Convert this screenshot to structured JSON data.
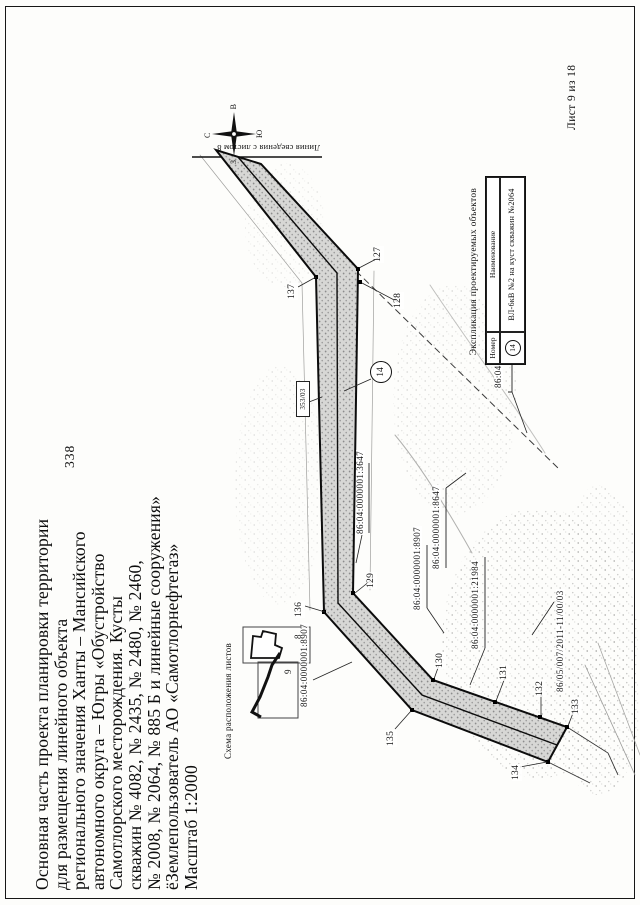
{
  "page": {
    "number": "338",
    "sheet_label": "Лист 9 из 18"
  },
  "title": {
    "lines": [
      "Основная часть проекта планировки территории",
      "для размещения линейного объекта",
      "регионального значения Ханты – Мансийского",
      "автономного округа – Югры «Обустройство",
      "Самотлорского месторождения. Кусты",
      "скважин № 4082, № 2435, № 2480, № 2460,",
      "№ 2008, № 2064, № 885 Б и линейные сооружения»",
      "ёЗемлепользователь АО «Самотлорнефтегаз»",
      "Масштаб 1:2000"
    ]
  },
  "compass": {
    "north": "С",
    "south": "Ю",
    "west": "З",
    "east": "В"
  },
  "map": {
    "match_line_label": "Линия сведения с листом 8",
    "marker_14": "14",
    "support_flag": "353/03",
    "points": {
      "p127": "127",
      "p128": "128",
      "p129": "129",
      "p130": "130",
      "p131": "131",
      "p132": "132",
      "p133": "133",
      "p134": "134",
      "p135": "135",
      "p136": "136",
      "p137": "137"
    },
    "cadastral": {
      "c36392": "86:04:0000001:36392",
      "c3647": "86:04:0000001:3647",
      "c8647": "86:04:0000001:8647",
      "c8907a": "86:04:0000001:8907",
      "c8907b": "86:04:0000001:8907",
      "c21984": "86:04:0000001:21984",
      "c8605": "86/05/007/2011-11/00/03"
    }
  },
  "inset": {
    "caption": "Схема расположения листов",
    "sheet8": "8",
    "sheet9": "9"
  },
  "explication": {
    "caption": "Экспликация проектируемых объектов",
    "col_number": "Номер",
    "col_name": "Наименование",
    "row_number": "14",
    "row_name": "ВЛ-6кВ №2 на куст скважин №2064"
  }
}
